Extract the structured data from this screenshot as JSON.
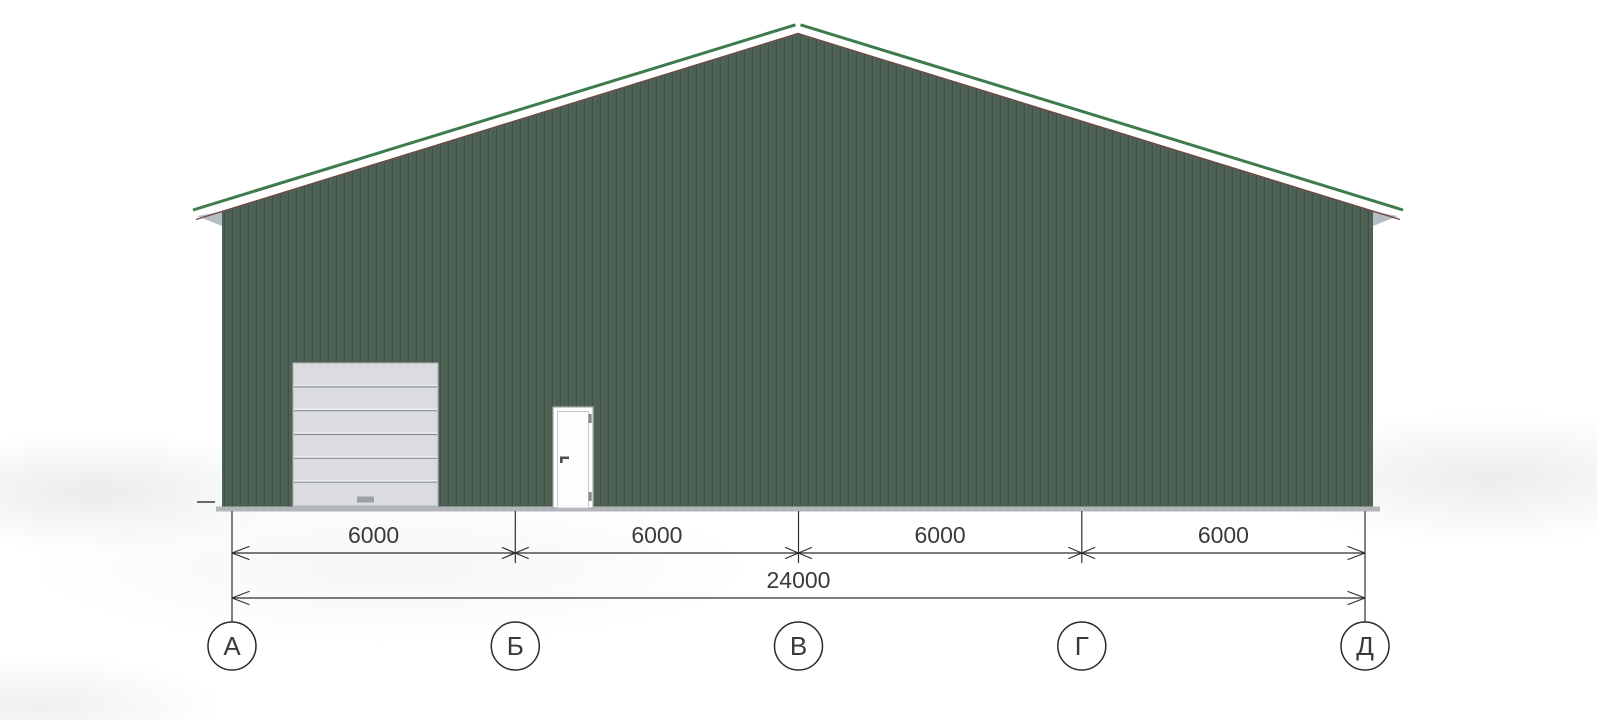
{
  "drawing": {
    "axes": [
      {
        "label": "А"
      },
      {
        "label": "Б"
      },
      {
        "label": "В"
      },
      {
        "label": "Г"
      },
      {
        "label": "Д"
      }
    ],
    "dimensions": {
      "segments": [
        {
          "label": "6000"
        },
        {
          "label": "6000"
        },
        {
          "label": "6000"
        },
        {
          "label": "6000"
        }
      ],
      "total": {
        "label": "24000"
      }
    },
    "building": {
      "gate_panel_count": 6,
      "colors": {
        "wall_green": "#4d6054",
        "wall_rib_dark": "#3e5146",
        "wall_rib_light": "#586a5d",
        "roof_trim_green": "#3e7b4f",
        "roof_edge_brown": "#6e4a45",
        "eave_gray": "#b7bdc5",
        "plinth_gray": "#b2b5ba",
        "gate_gray": "#dadce0",
        "line_dark": "#2f2f2f"
      }
    }
  }
}
